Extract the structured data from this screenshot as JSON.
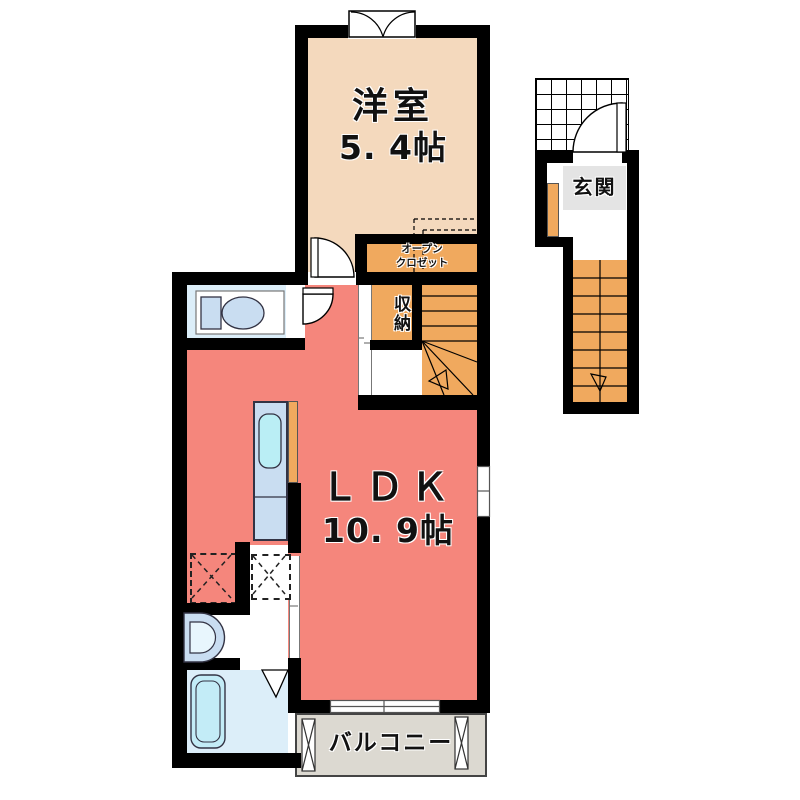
{
  "rooms": {
    "western": {
      "name": "洋室",
      "size": "5. 4帖"
    },
    "ldk": {
      "name": "ＬＤＫ",
      "size": "10. 9帖"
    },
    "storage": {
      "name": "収納"
    },
    "closet": {
      "line1": "オープン",
      "line2": "クロゼット"
    },
    "entrance": {
      "name": "玄関"
    },
    "balcony": {
      "name": "バルコニー"
    }
  },
  "colors": {
    "wall": "#000000",
    "western_floor": "#f4d9bd",
    "ldk_floor": "#f5867c",
    "wood_orange": "#f0a95e",
    "wet_area_floor": "#dceef9",
    "fixture_blue": "#c9ddf1",
    "sink_cyan": "#baeef5",
    "balcony_floor": "#dcd9d1",
    "entrance_floor": "#e4e4e4"
  }
}
